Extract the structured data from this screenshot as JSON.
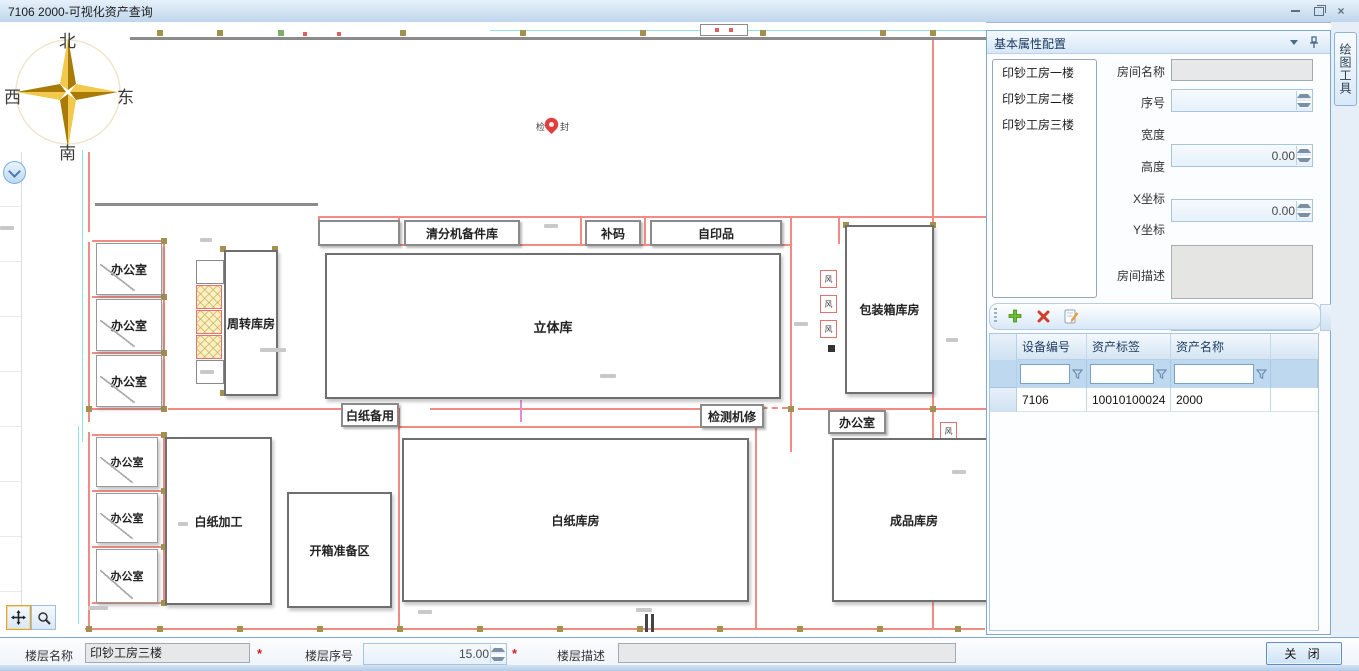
{
  "window": {
    "title": "7106 2000-可视化资产查询"
  },
  "icons": {
    "minimize": "minimize-icon",
    "restore": "restore-icon",
    "close": "close-icon",
    "header_collapse": "chevron-down-icon",
    "header_pin": "pushpin-icon",
    "left_collapse": "chevron-down-icon",
    "pan_tool": "move-icon",
    "zoom_tool": "magnifier-icon",
    "add": "plus-icon",
    "delete": "delete-icon",
    "edit": "edit-note-icon",
    "filter": "funnel-icon",
    "marker": "map-pin-icon"
  },
  "compass": {
    "north": "北",
    "south": "南",
    "east": "东",
    "west": "西"
  },
  "map": {
    "pin_label_left": "检",
    "pin_label_right": "封",
    "rooms": {
      "office": "办公室",
      "zhouzhuan": "周转库房",
      "qingfenji": "清分机备件库",
      "buma": "补码",
      "ziyinpin": "自印品",
      "liti": "立体库",
      "baozhuang": "包装箱库房",
      "baizhi_beiyong": "白纸备用",
      "jiance_jixiu": "检测机修",
      "baizhi_jiagong": "白纸加工",
      "kaixiang": "开箱准备区",
      "baizhi_kufang": "白纸库房",
      "chengpin": "成品库房",
      "vent": "风"
    }
  },
  "panel": {
    "title": "基本属性配置",
    "floors": [
      "印钞工房一楼",
      "印钞工房二楼",
      "印钞工房三楼"
    ],
    "fields": {
      "room_name": {
        "label": "房间名称",
        "value": ""
      },
      "seq": {
        "label": "序号",
        "value": ""
      },
      "width": {
        "label": "宽度",
        "value": "0.00"
      },
      "height": {
        "label": "高度",
        "value": "0.00"
      },
      "x": {
        "label": "X坐标",
        "value": "0.00"
      },
      "y": {
        "label": "Y坐标",
        "value": "0.00"
      },
      "desc": {
        "label": "房间描述",
        "value": ""
      }
    },
    "table": {
      "columns": [
        "设备编号",
        "资产标签",
        "资产名称"
      ],
      "rows": [
        [
          "7106",
          "10010100024",
          "2000"
        ]
      ]
    }
  },
  "side_tab": {
    "label": "绘图工具"
  },
  "footer": {
    "floor_name": {
      "label": "楼层名称",
      "value": "印钞工房三楼"
    },
    "floor_seq": {
      "label": "楼层序号",
      "value": "15.00"
    },
    "floor_desc": {
      "label": "楼层描述",
      "value": ""
    },
    "required_mark": "*",
    "close_button": "关 闭"
  }
}
